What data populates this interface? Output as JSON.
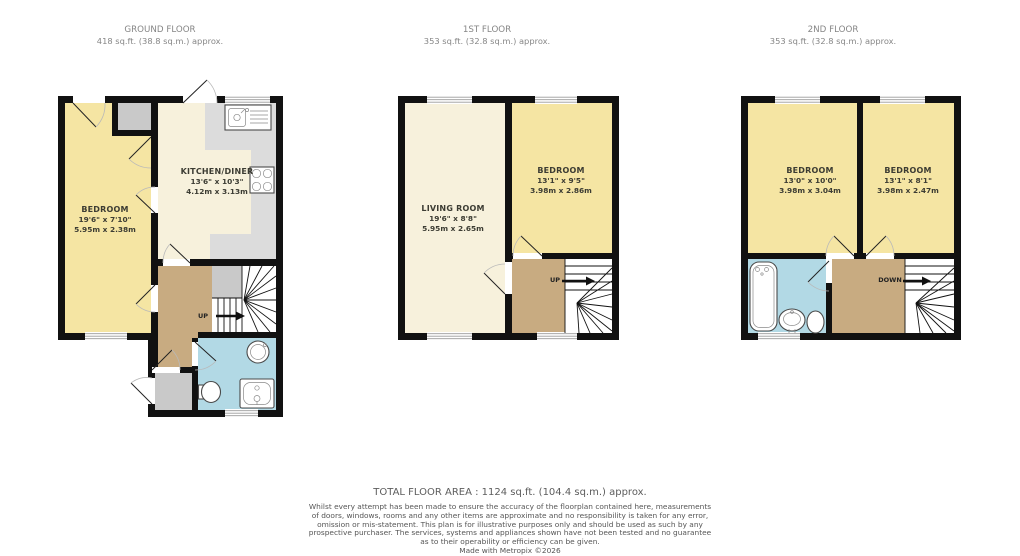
{
  "floors": [
    {
      "id": "ground",
      "title": "GROUND FLOOR",
      "area": "418 sq.ft. (38.8 sq.m.) approx.",
      "rooms": [
        {
          "name": "BEDROOM",
          "imperial": "19'6\" x 7'10\"",
          "metric": "5.95m x 2.38m"
        },
        {
          "name": "KITCHEN/DINER",
          "imperial": "13'6\" x 10'3\"",
          "metric": "4.12m x 3.13m"
        }
      ],
      "stair_label": "UP"
    },
    {
      "id": "first",
      "title": "1ST FLOOR",
      "area": "353 sq.ft. (32.8 sq.m.) approx.",
      "rooms": [
        {
          "name": "LIVING ROOM",
          "imperial": "19'6\" x 8'8\"",
          "metric": "5.95m x 2.65m"
        },
        {
          "name": "BEDROOM",
          "imperial": "13'1\" x 9'5\"",
          "metric": "3.98m x 2.86m"
        }
      ],
      "stair_label": "UP"
    },
    {
      "id": "second",
      "title": "2ND FLOOR",
      "area": "353 sq.ft. (32.8 sq.m.) approx.",
      "rooms": [
        {
          "name": "BEDROOM",
          "imperial": "13'0\" x 10'0\"",
          "metric": "3.98m x 3.04m"
        },
        {
          "name": "BEDROOM",
          "imperial": "13'1\" x 8'1\"",
          "metric": "3.98m x 2.47m"
        }
      ],
      "stair_label": "DOWN"
    }
  ],
  "footer": {
    "total": "TOTAL FLOOR AREA : 1124 sq.ft. (104.4 sq.m.) approx.",
    "disclaimer_lines": [
      "Whilst every attempt has been made to ensure the accuracy of the floorplan contained here, measurements",
      "of doors, windows, rooms and any other items are approximate and no responsibility is taken for any error,",
      "omission or mis-statement. This plan is for illustrative purposes only and should be used as such by any",
      "prospective purchaser. The services, systems and appliances shown have not been tested and no guarantee",
      "as to their operability or efficiency can be given."
    ],
    "credit": "Made with Metropix ©2026"
  },
  "colors": {
    "wall": "#111111",
    "room_yellow": "#f5e5a3",
    "room_cream": "#f7f1dc",
    "hall_brown": "#c8ab81",
    "bath_blue": "#b2d9e5",
    "counter_gray": "#dcdcdc",
    "unit_gray": "#c9c9c9",
    "header_text": "#868686",
    "label_text": "#3c3c33",
    "footer_text": "#555555"
  }
}
